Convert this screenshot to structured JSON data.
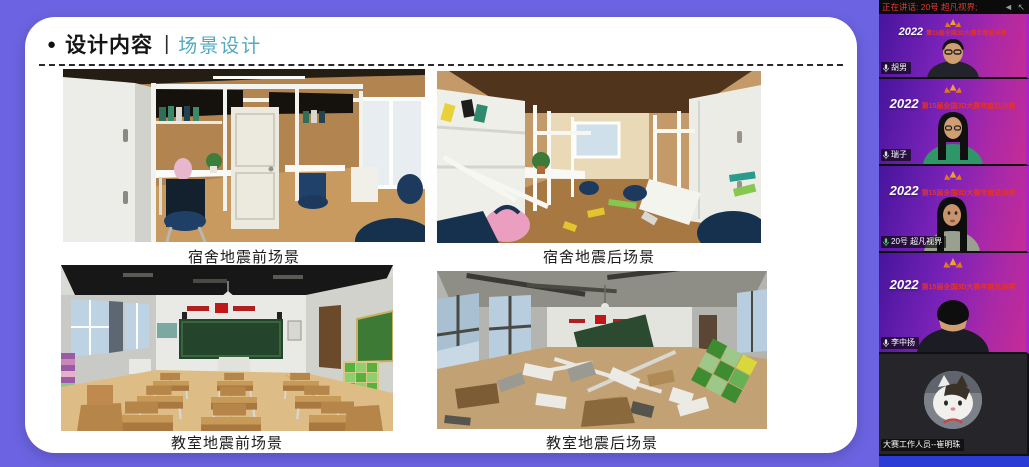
{
  "slide": {
    "bullet": "●",
    "title": "设计内容",
    "separator": "|",
    "subtitle": "场景设计",
    "captions": {
      "dorm_before": "宿舍地震前场景",
      "dorm_after": "宿舍地震后场景",
      "class_before": "教室地震前场景",
      "class_after": "教室地震后场景"
    }
  },
  "sidebar": {
    "status_text": "正在讲话: 20号 超凡视界;",
    "arrows_glyph": "◄ ↖",
    "banner": {
      "year": "2022",
      "title": "第15届全国3D大赛年度总决赛"
    },
    "participants": [
      {
        "name": "胡男",
        "speaking": false
      },
      {
        "name": "瑞子",
        "speaking": false
      },
      {
        "name": "20号 超凡视界",
        "speaking": true
      },
      {
        "name": "李中扬",
        "speaking": false
      },
      {
        "name": "大赛工作人员--崔明珠",
        "speaking": false
      }
    ]
  },
  "colors": {
    "page_background": "#6c63e2",
    "subtitle_teal": "#4fa9c2",
    "status_red": "#e03b30",
    "banner_red": "#e63226",
    "bottom_strip_blue": "#2b3cd6"
  }
}
